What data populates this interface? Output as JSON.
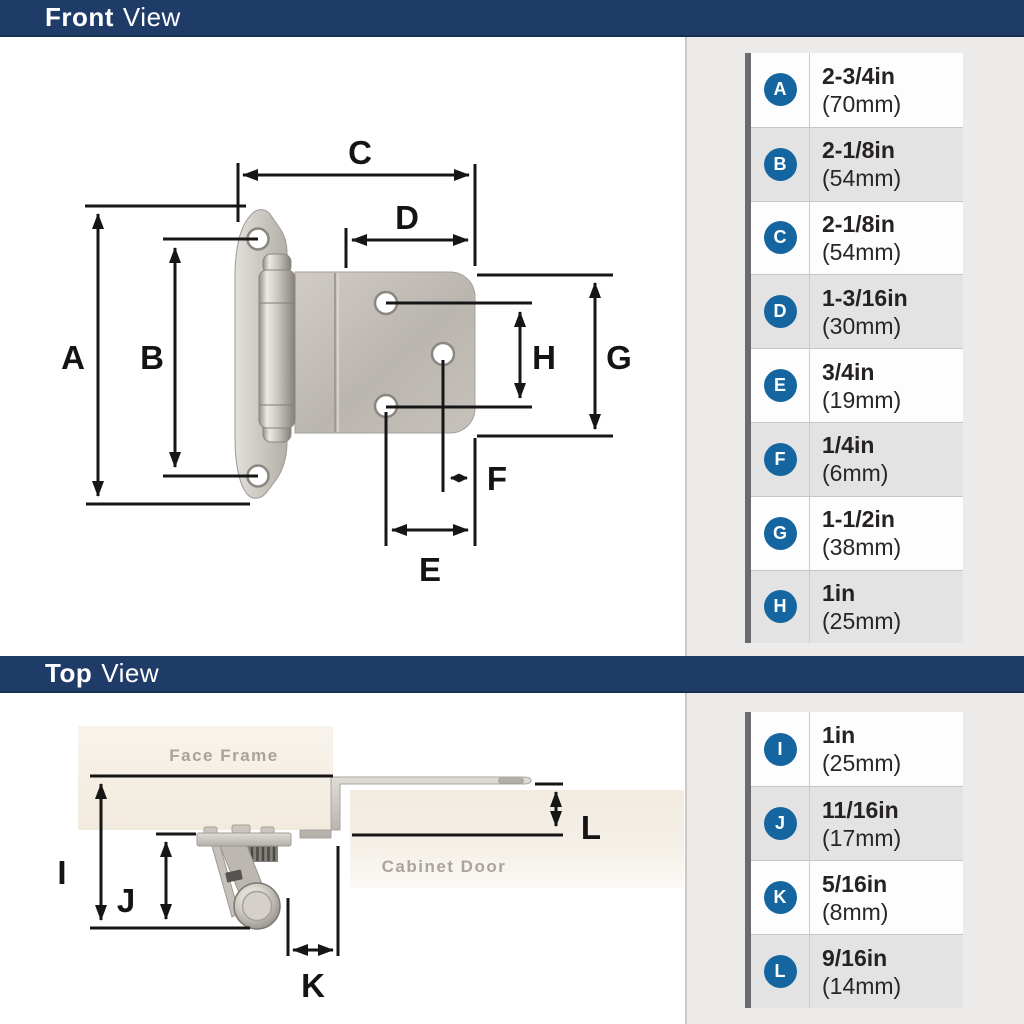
{
  "colors": {
    "header_navy": "#1f3c69",
    "badge_blue": "#1566a0",
    "table_bar_gray": "#6a6b6e",
    "panel_bg": "#edebea",
    "row_alt_gray": "#e3e3e3",
    "dimension_line": "#161616"
  },
  "front_section": {
    "header": {
      "title_bold": "Front",
      "title_regular": "View"
    },
    "diagram": {
      "labels": {
        "a": "A",
        "b": "B",
        "c": "C",
        "d": "D",
        "e": "E",
        "f": "F",
        "g": "G",
        "h": "H"
      }
    },
    "table": {
      "rows": [
        {
          "letter": "A",
          "inches": "2-3/4in",
          "mm": "(70mm)"
        },
        {
          "letter": "B",
          "inches": "2-1/8in",
          "mm": "(54mm)"
        },
        {
          "letter": "C",
          "inches": "2-1/8in",
          "mm": "(54mm)"
        },
        {
          "letter": "D",
          "inches": "1-3/16in",
          "mm": "(30mm)"
        },
        {
          "letter": "E",
          "inches": "3/4in",
          "mm": "(19mm)"
        },
        {
          "letter": "F",
          "inches": "1/4in",
          "mm": "(6mm)"
        },
        {
          "letter": "G",
          "inches": "1-1/2in",
          "mm": "(38mm)"
        },
        {
          "letter": "H",
          "inches": "1in",
          "mm": "(25mm)"
        }
      ]
    }
  },
  "top_section": {
    "header": {
      "title_bold": "Top",
      "title_regular": "View"
    },
    "diagram": {
      "labels": {
        "i": "I",
        "j": "J",
        "k": "K",
        "l": "L"
      },
      "annotations": {
        "face_frame": "Face Frame",
        "cabinet_door": "Cabinet Door"
      }
    },
    "table": {
      "rows": [
        {
          "letter": "I",
          "inches": "1in",
          "mm": "(25mm)"
        },
        {
          "letter": "J",
          "inches": "11/16in",
          "mm": "(17mm)"
        },
        {
          "letter": "K",
          "inches": "5/16in",
          "mm": "(8mm)"
        },
        {
          "letter": "L",
          "inches": "9/16in",
          "mm": "(14mm)"
        }
      ]
    }
  }
}
